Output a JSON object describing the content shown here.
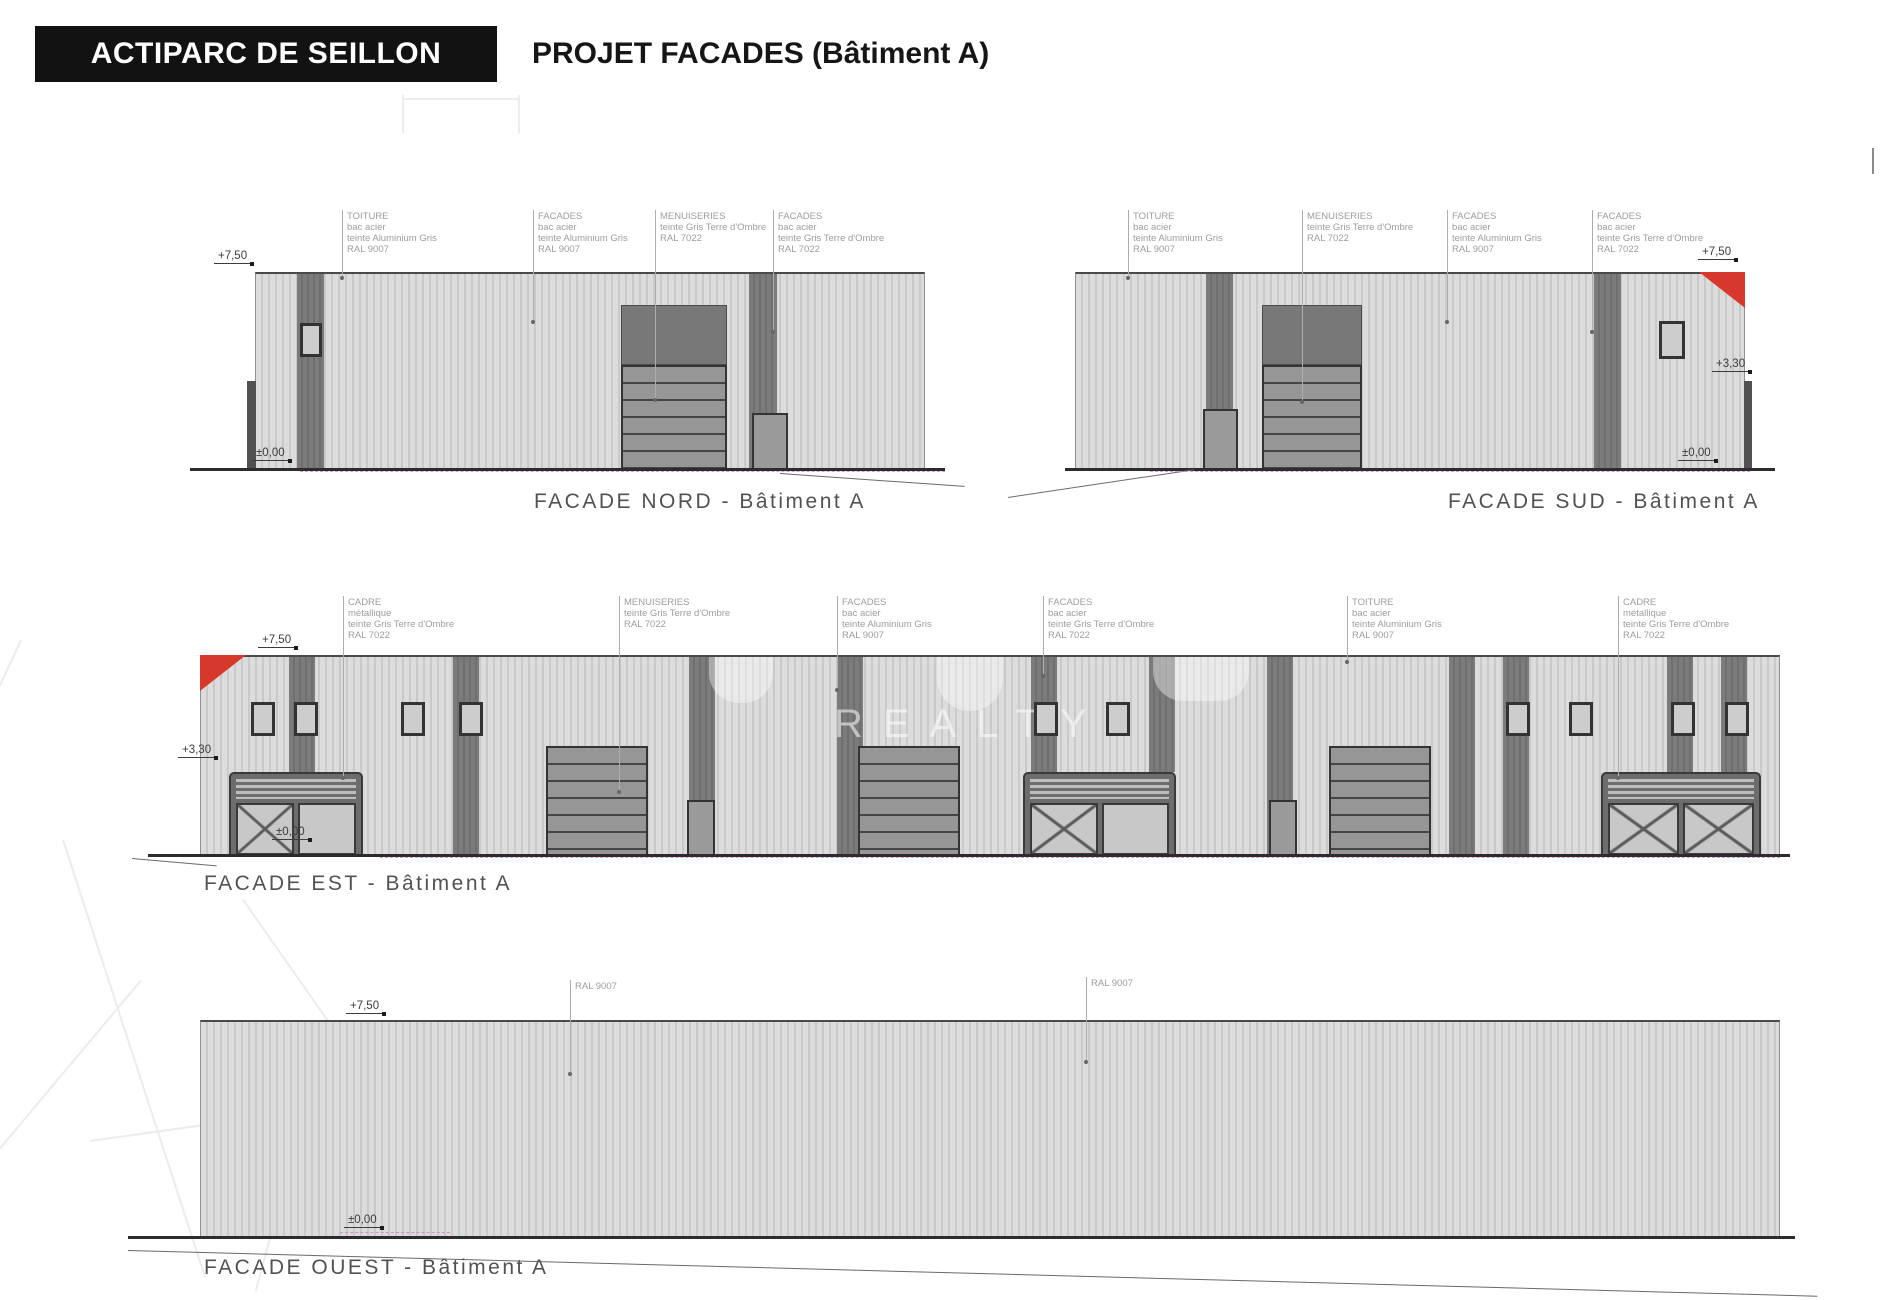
{
  "header": {
    "badge": "ACTIPARC DE SEILLON",
    "title": "PROJET FACADES (Bâtiment A)"
  },
  "watermark": {
    "text": "REALTY"
  },
  "colors": {
    "accent_red": "#d6392b",
    "facade_light_gray": "#d2d2d2",
    "facade_dark_gray": "#6f6f6f",
    "terrain_magenta": "#df7fd0",
    "annotation_gray": "#9d9d9d"
  },
  "facades": {
    "nord": {
      "title": "FACADE NORD - Bâtiment A",
      "levels": {
        "top": "+7,50",
        "ground": "±0,00"
      },
      "annotations": [
        {
          "lines": [
            "TOITURE",
            "bac acier",
            "teinte Aluminium Gris",
            "RAL 9007"
          ]
        },
        {
          "lines": [
            "FACADES",
            "bac acier",
            "teinte Aluminium Gris",
            "RAL 9007"
          ]
        },
        {
          "lines": [
            "MENUISERIES",
            "teinte Gris Terre d'Ombre",
            "RAL 7022"
          ]
        },
        {
          "lines": [
            "FACADES",
            "bac acier",
            "teinte Gris Terre d'Ombre",
            "RAL 7022"
          ]
        }
      ]
    },
    "sud": {
      "title": "FACADE SUD - Bâtiment A",
      "levels": {
        "top": "+7,50",
        "mid": "+3,30",
        "ground": "±0,00"
      },
      "annotations": [
        {
          "lines": [
            "TOITURE",
            "bac acier",
            "teinte Aluminium Gris",
            "RAL 9007"
          ]
        },
        {
          "lines": [
            "MENUISERIES",
            "teinte Gris Terre d'Ombre",
            "RAL 7022"
          ]
        },
        {
          "lines": [
            "FACADES",
            "bac acier",
            "teinte Aluminium Gris",
            "RAL 9007"
          ]
        },
        {
          "lines": [
            "FACADES",
            "bac acier",
            "teinte Gris Terre d'Ombre",
            "RAL 7022"
          ]
        }
      ]
    },
    "est": {
      "title": "FACADE EST - Bâtiment A",
      "levels": {
        "top": "+7,50",
        "mid": "+3,30",
        "ground": "±0,00"
      },
      "annotations": [
        {
          "lines": [
            "CADRE",
            "métallique",
            "teinte Gris Terre d'Ombre",
            "RAL 7022"
          ]
        },
        {
          "lines": [
            "MENUISERIES",
            "teinte Gris Terre d'Ombre",
            "RAL 7022"
          ]
        },
        {
          "lines": [
            "FACADES",
            "bac acier",
            "teinte Aluminium Gris",
            "RAL 9007"
          ]
        },
        {
          "lines": [
            "FACADES",
            "bac acier",
            "teinte Gris Terre d'Ombre",
            "RAL 7022"
          ]
        },
        {
          "lines": [
            "TOITURE",
            "bac acier",
            "teinte Aluminium Gris",
            "RAL 9007"
          ]
        },
        {
          "lines": [
            "CADRE",
            "métallique",
            "teinte Gris Terre d'Ombre",
            "RAL 7022"
          ]
        }
      ]
    },
    "ouest": {
      "title": "FACADE OUEST - Bâtiment A",
      "levels": {
        "top": "+7,50",
        "ground": "±0,00"
      },
      "annotations": [
        {
          "lines": [
            "RAL 9007"
          ]
        },
        {
          "lines": [
            "RAL 9007"
          ]
        }
      ]
    }
  }
}
